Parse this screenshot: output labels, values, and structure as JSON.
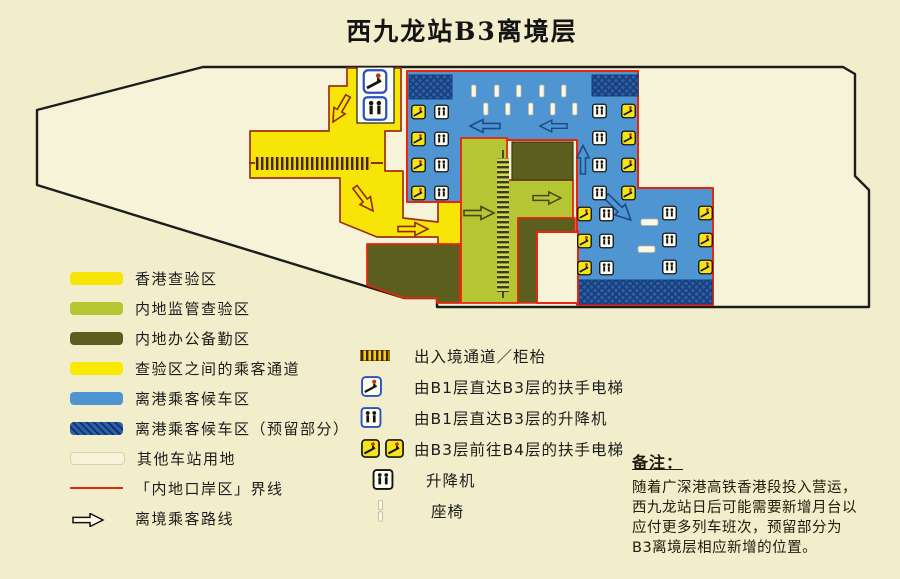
{
  "title": "西九龙站B3离境层",
  "legend_areas": [
    {
      "label": "香港查验区",
      "swatch": "hk-inspection-yellow"
    },
    {
      "label": "内地监管查验区",
      "swatch": "mainland-inspection-green"
    },
    {
      "label": "内地办公备勤区",
      "swatch": "mainland-office-olive"
    },
    {
      "label": "查验区之间的乘客通道",
      "swatch": "corridor-yellow"
    },
    {
      "label": "离港乘客候车区",
      "swatch": "waiting-light-blue"
    },
    {
      "label": "离港乘客候车区（预留部分）",
      "swatch": "waiting-reserved-dark-blue"
    },
    {
      "label": "其他车站用地",
      "swatch": "other-land-cream"
    },
    {
      "label": "「内地口岸区」界线",
      "swatch": "port-boundary-red-line"
    },
    {
      "label": "离境乘客路线",
      "swatch": "route-arrow"
    }
  ],
  "legend_symbols": [
    {
      "label": "出入境通道／柜枱",
      "icon": "counter-stripes-icon"
    },
    {
      "label": "由B1层直达B3层的扶手电梯",
      "icon": "escalator-blue-icon"
    },
    {
      "label": "由B1层直达B3层的升降机",
      "icon": "lift-blue-icon"
    },
    {
      "label": "由B3层前往B4层的扶手电梯",
      "icon": "escalator-yellow-icon-x2"
    },
    {
      "label": "升降机",
      "icon": "lift-black-icon"
    },
    {
      "label": "座椅",
      "icon": "seat-icon"
    }
  ],
  "note": {
    "heading": "备注：",
    "lines": [
      "随着广深港高铁香港段投入营运，",
      "西九龙站日后可能需要新增月台以",
      "应付更多列车班次，预留部分为",
      "B3离境层相应新增的位置。"
    ]
  },
  "colors": {
    "page_background": "#f2eecb",
    "station_cream": "#f7f3d8",
    "hk_inspection_yellow": "#f6e506",
    "mainland_inspection_green": "#b5c634",
    "mainland_office_olive": "#5c5e1e",
    "waiting_light_blue": "#4e95d2",
    "waiting_reserved_dark_blue": "#2d5ea8",
    "port_boundary_red": "#e8250e",
    "outline_black": "#1c1c1c"
  }
}
